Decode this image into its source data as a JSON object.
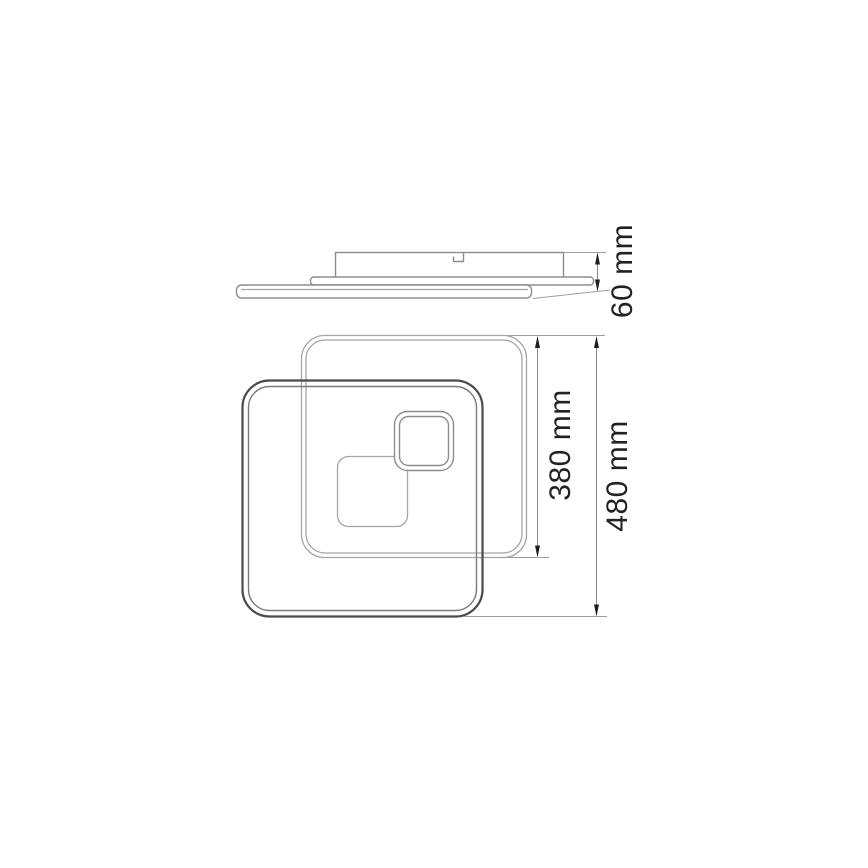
{
  "dimensions": {
    "profile_height": {
      "label": "60 mm",
      "value": 60,
      "unit": "mm"
    },
    "back_frame_size": {
      "label": "380 mm",
      "value": 380,
      "unit": "mm"
    },
    "overall_size": {
      "label": "480 mm",
      "value": 480,
      "unit": "mm"
    }
  },
  "colors": {
    "background": "#ffffff",
    "line_light": "#a5a5a5",
    "line_medium": "#8d8d8d",
    "line_dark": "#4a4a4a",
    "dimension_line": "#8a8a8a",
    "text": "#222222"
  }
}
